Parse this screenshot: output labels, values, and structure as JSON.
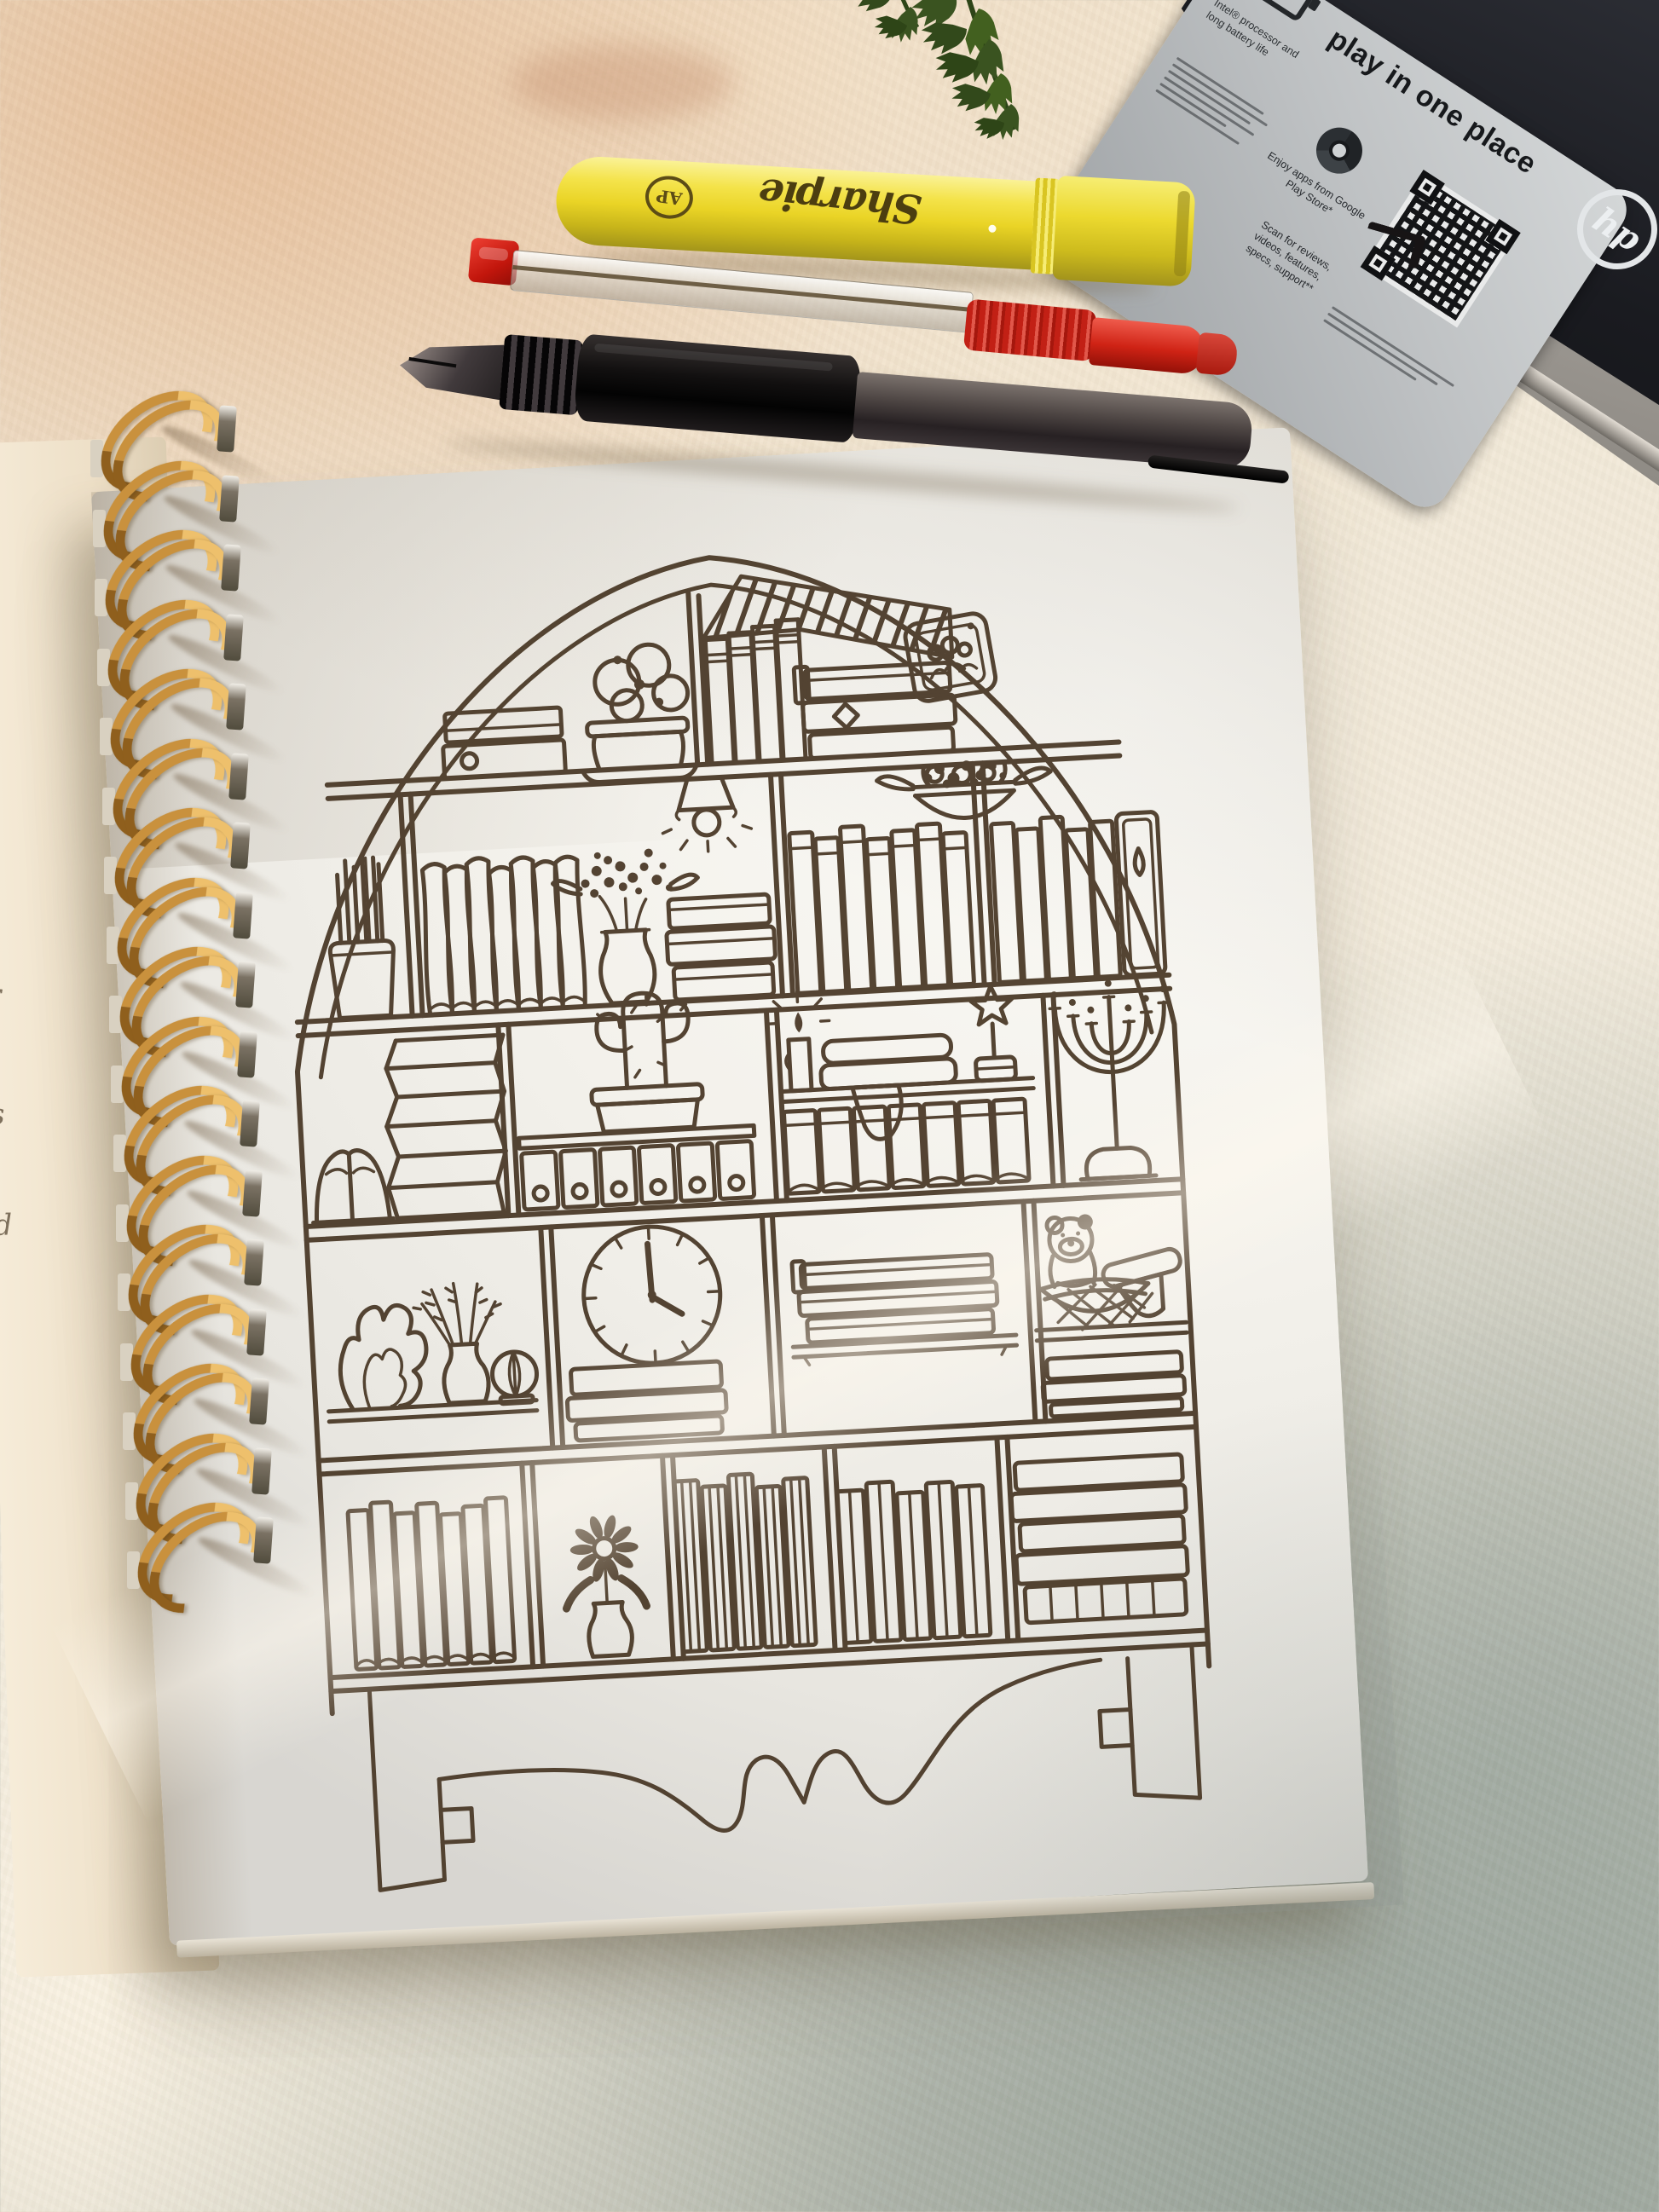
{
  "scene": {
    "description": "Top-down photo of a spiral-bound sketchbook on a white textured cloth showing a hand-drawn arched bookshelf coloring page, with a yellow Sharpie highlighter, a red gel pen and a black ballpoint pen above it, a fern leaf and the corner of an HP laptop at top right"
  },
  "laptop": {
    "brand_logo": "hp",
    "sticker": {
      "headline": "play in one place",
      "intel_line": "Intel® processor and long battery life",
      "chrome_caption": "Enjoy apps from Google Play Store*",
      "qr_caption": "Scan for reviews, videos, features, specs, support**"
    }
  },
  "highlighter": {
    "brand_script": "Sharpie",
    "cert_mark": "AP"
  },
  "notebook": {
    "coil_count": 17,
    "handwriting_partial_letters": [
      "r",
      "s",
      "d"
    ]
  },
  "drawing": {
    "subject": "arched bookshelf doodle",
    "items": [
      "stacked books",
      "peony flower pot",
      "dark-top books",
      "book stack with diamond",
      "framed family photo",
      "pendant lamp",
      "hanging flower basket",
      "pencil cup",
      "leaning wavy books",
      "berry flower vase",
      "small book stack",
      "book row",
      "binder with teardrop hole",
      "open book",
      "zigzag book pile",
      "cactus pot",
      "ring binders",
      "lit candle",
      "folded blankets",
      "star trophy",
      "curled book row",
      "menorah",
      "flame coral",
      "lavender vase",
      "ball cactus",
      "wall clock",
      "book stack under clock",
      "floating shelf books",
      "teddy bear in basket",
      "rolled blanket",
      "book stack",
      "book row",
      "daisy in vase",
      "tall book spines",
      "book group",
      "striped book stack",
      "heart cutout apron",
      "bench legs"
    ]
  }
}
